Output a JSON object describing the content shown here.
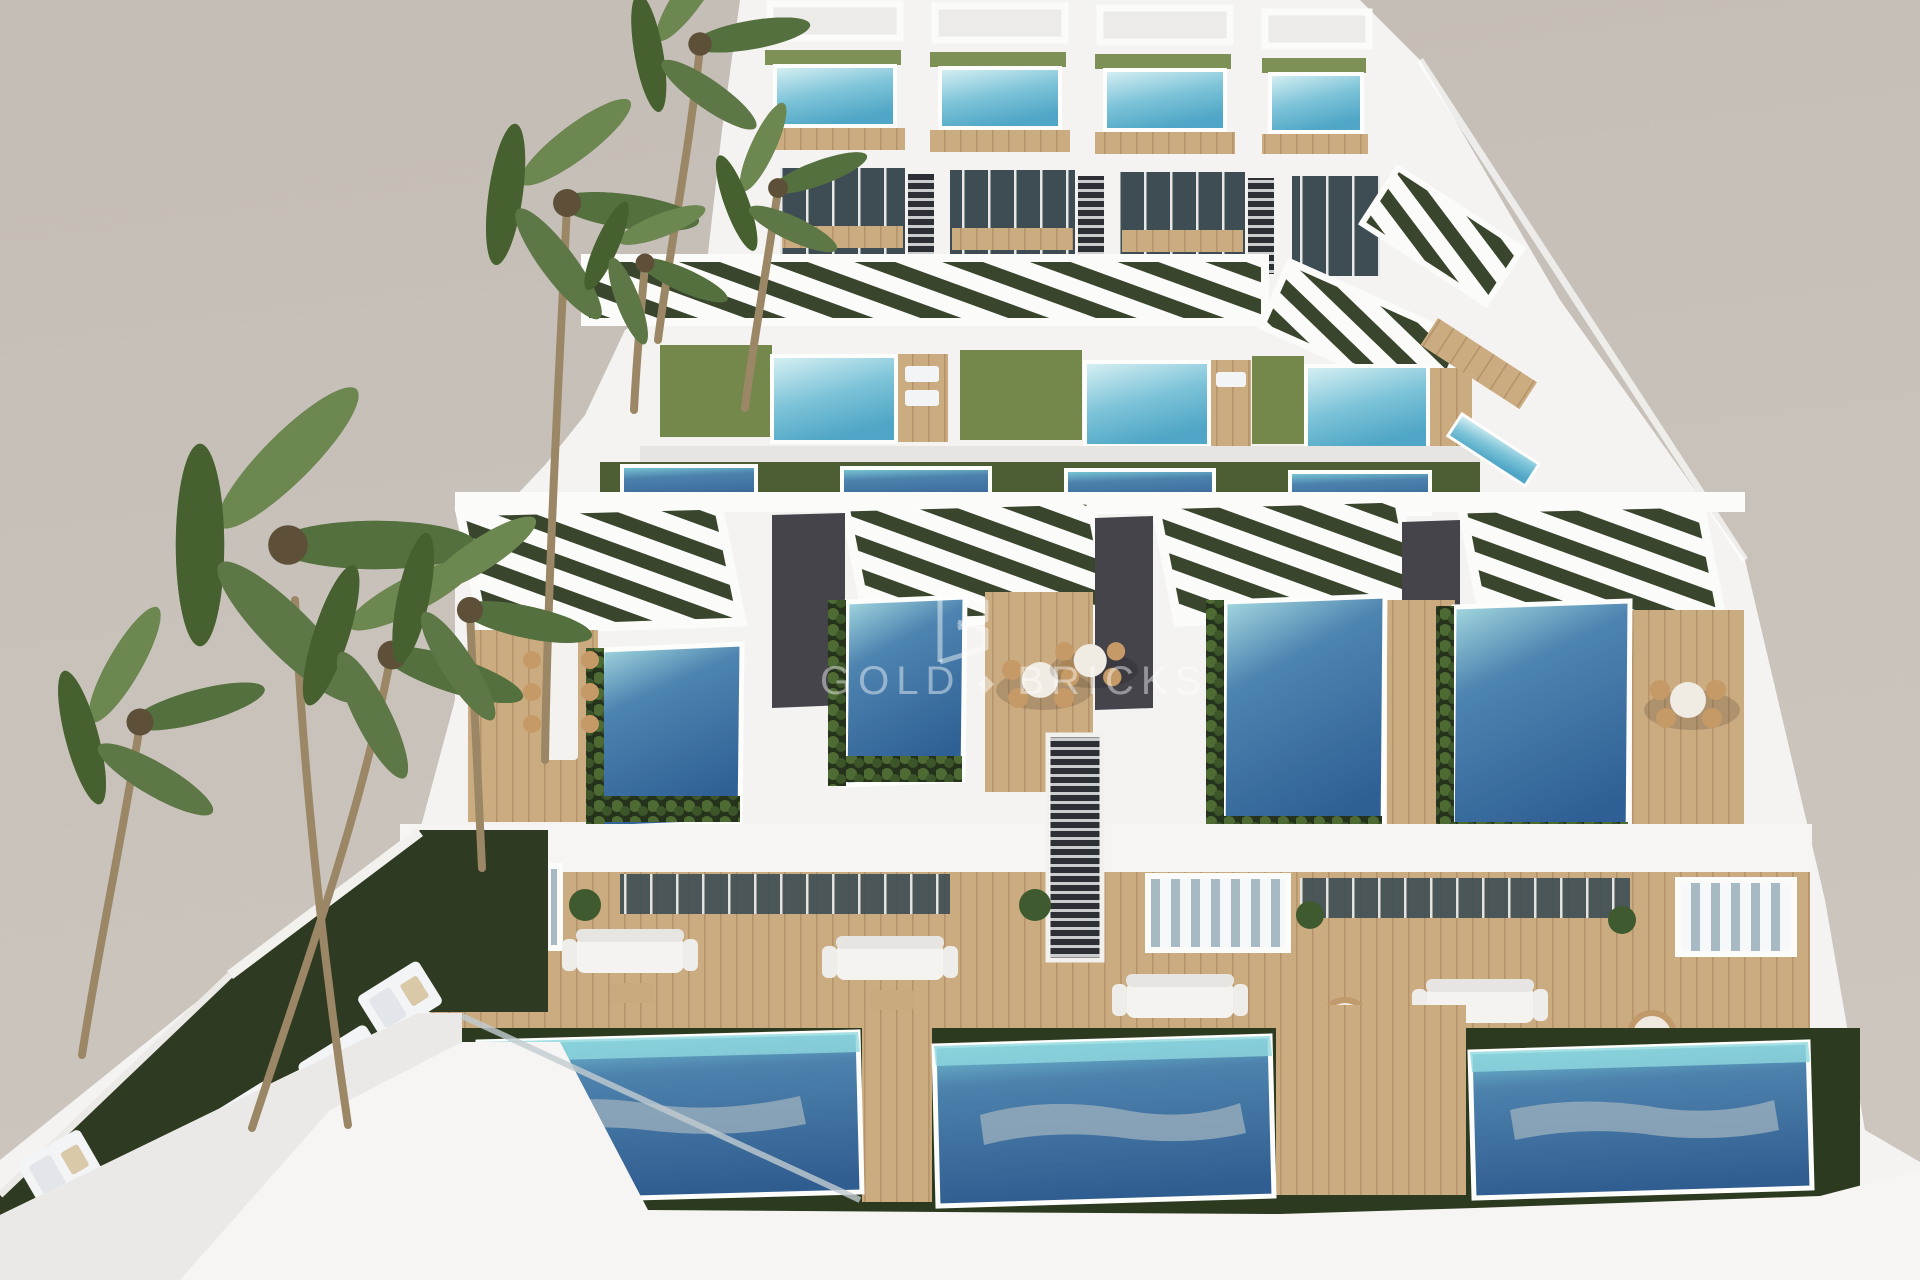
{
  "scene": {
    "title": "aerial-render-modern-villa-complex",
    "description": "Aerial 3D architectural rendering of a terraced modern white villa development with rooftop pools, ground-level pools, wooden sun decks, hedges and palm trees on a plain warm-grey studio background.",
    "watermark": {
      "word1": "GOLD",
      "separator": "◆",
      "word2": "BRICKS",
      "logo_letter": "B",
      "color": "#ffffff"
    },
    "palette": {
      "background": "#c6bfb6",
      "structure_white": "#f4f3f1",
      "structure_shade": "#e3e2df",
      "pool_cyan_light": "#d9f1f4",
      "pool_cyan": "#7cc3d8",
      "pool_blue_mid": "#4e84b0",
      "pool_blue_deep": "#2f6095",
      "pool_reflection": "#9fb2bd",
      "wood_deck": "#cbab80",
      "wood_dark": "#b6946b",
      "lawn_roof": "#74884c",
      "lawn_ground": "#2e3a21",
      "hedge": "#2c3a1f",
      "glass": "#3d4d53",
      "path_dark": "#45444b",
      "palm_leaf": "#5e7746",
      "palm_trunk": "#9b8765"
    },
    "counts": {
      "back_row_villas": 4,
      "middle_row_villas": 3,
      "front_row_villas": 4,
      "rooftop_pools": 11,
      "lap_pools": 4,
      "ground_pools": 3,
      "palm_trees": 8,
      "sun_loungers": 4,
      "dining_sets": 4,
      "sofa_sets": 4
    }
  }
}
